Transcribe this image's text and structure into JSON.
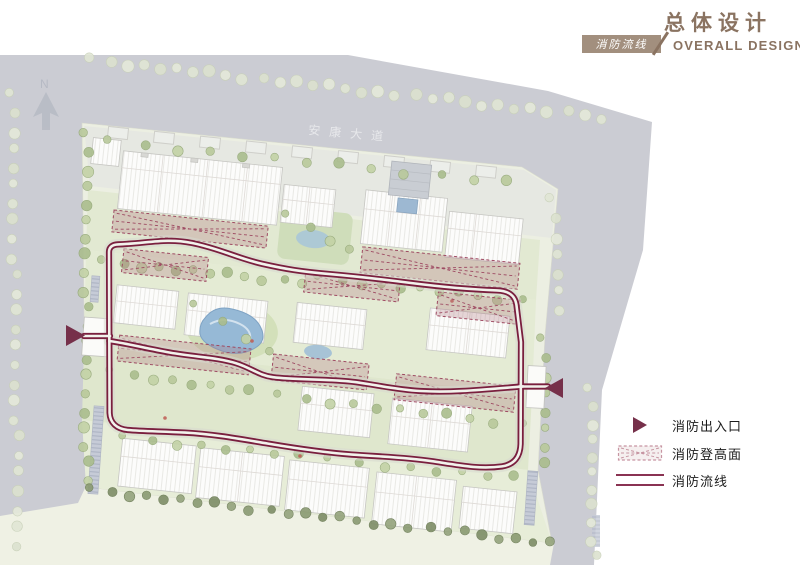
{
  "header": {
    "title_cn": "总体设计",
    "title_en": "OVERALL DESIGN",
    "tab_label": "消防流线"
  },
  "map": {
    "road_label": "安康大道",
    "north_label": "N"
  },
  "legend": {
    "items": [
      {
        "label": "消防出入口",
        "type": "triangle-entrance"
      },
      {
        "label": "消防登高面",
        "type": "hatched-area"
      },
      {
        "label": "消防流线",
        "type": "double-line"
      }
    ]
  },
  "colors": {
    "route": "#7a1f3e",
    "entrance_triangle": "#76304a",
    "hatch_stroke": "#9e4a62",
    "accent_brown": "#8a7361",
    "tab_bg": "#a28f7e",
    "road_gray": "#cbccd3",
    "site_green": "#ecefe2"
  }
}
